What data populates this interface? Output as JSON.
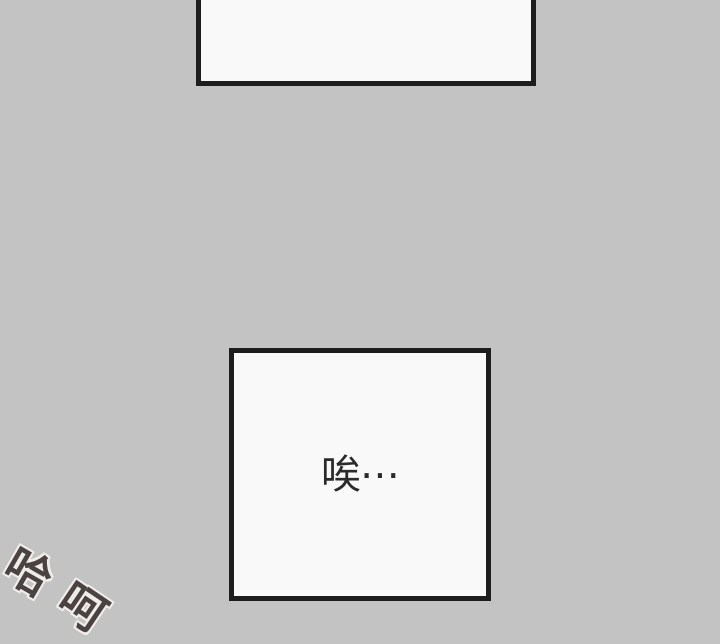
{
  "page": {
    "background_color": "#c3c3c3"
  },
  "panels": [
    {
      "name": "top-panel",
      "text": "",
      "fill": "#f9f9f9",
      "border_color": "#1d1d1d"
    },
    {
      "name": "dialog-panel",
      "text": "唉⋯",
      "fill": "#f9f9f9",
      "border_color": "#1d1d1d",
      "text_color": "#2b2b2b"
    }
  ],
  "sfx": {
    "text": "哈呵",
    "chars": [
      "哈",
      "呵"
    ],
    "fill_color": "#4a4341",
    "outline_color": "#efedea",
    "rotation_deg": 30
  }
}
